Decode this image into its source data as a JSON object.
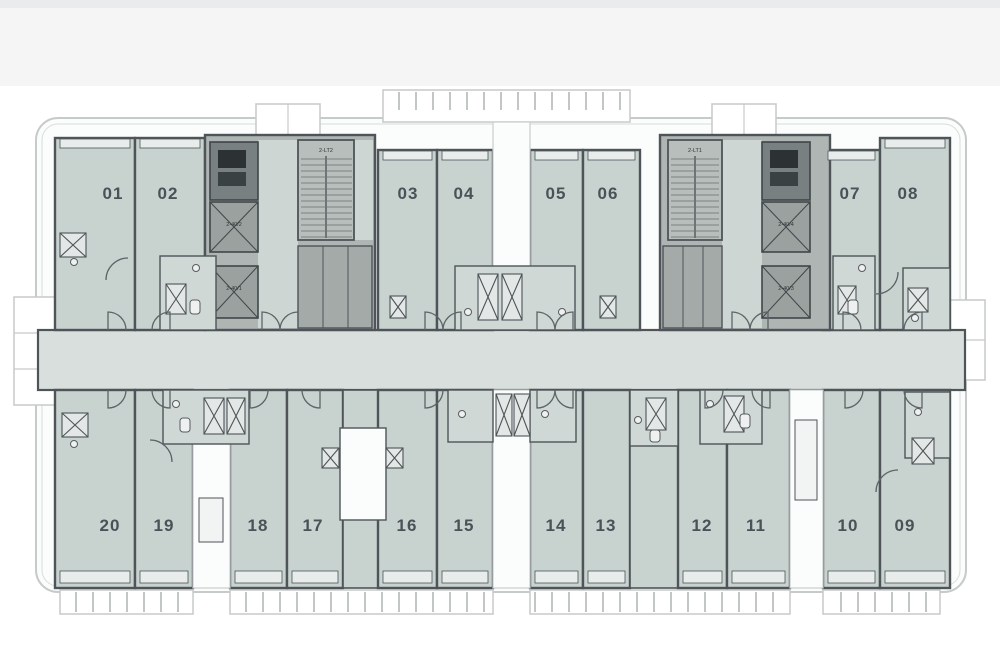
{
  "plan": {
    "type": "residential-floor-plan",
    "top_units": [
      "01",
      "02",
      "03",
      "04",
      "05",
      "06",
      "07",
      "08"
    ],
    "bottom_units": [
      "20",
      "19",
      "18",
      "17",
      "16",
      "15",
      "14",
      "13",
      "12",
      "11",
      "10",
      "09"
    ],
    "cores": {
      "left": {
        "stair_label": "2-LT2",
        "elevator_labels": [
          "2-40/2",
          "2-40/1"
        ]
      },
      "right": {
        "stair_label": "2-LT1",
        "elevator_labels": [
          "2-40/4",
          "2-40/3"
        ]
      }
    },
    "colors": {
      "unit_fill": "#c8d3d0",
      "corridor_fill": "#d8dfdc",
      "wall": "#4e5458",
      "core_fill": "#aeb5b2",
      "elevator_fill": "#9aa19f",
      "machine_room_fill": "#798082",
      "stair_fill": "#b7bebb",
      "lobby_fill": "#cdd6d2",
      "pod_fill": "#cfd8d4",
      "balcony_outline": "#c6cac9",
      "window_fill": "#e8edeb"
    }
  }
}
